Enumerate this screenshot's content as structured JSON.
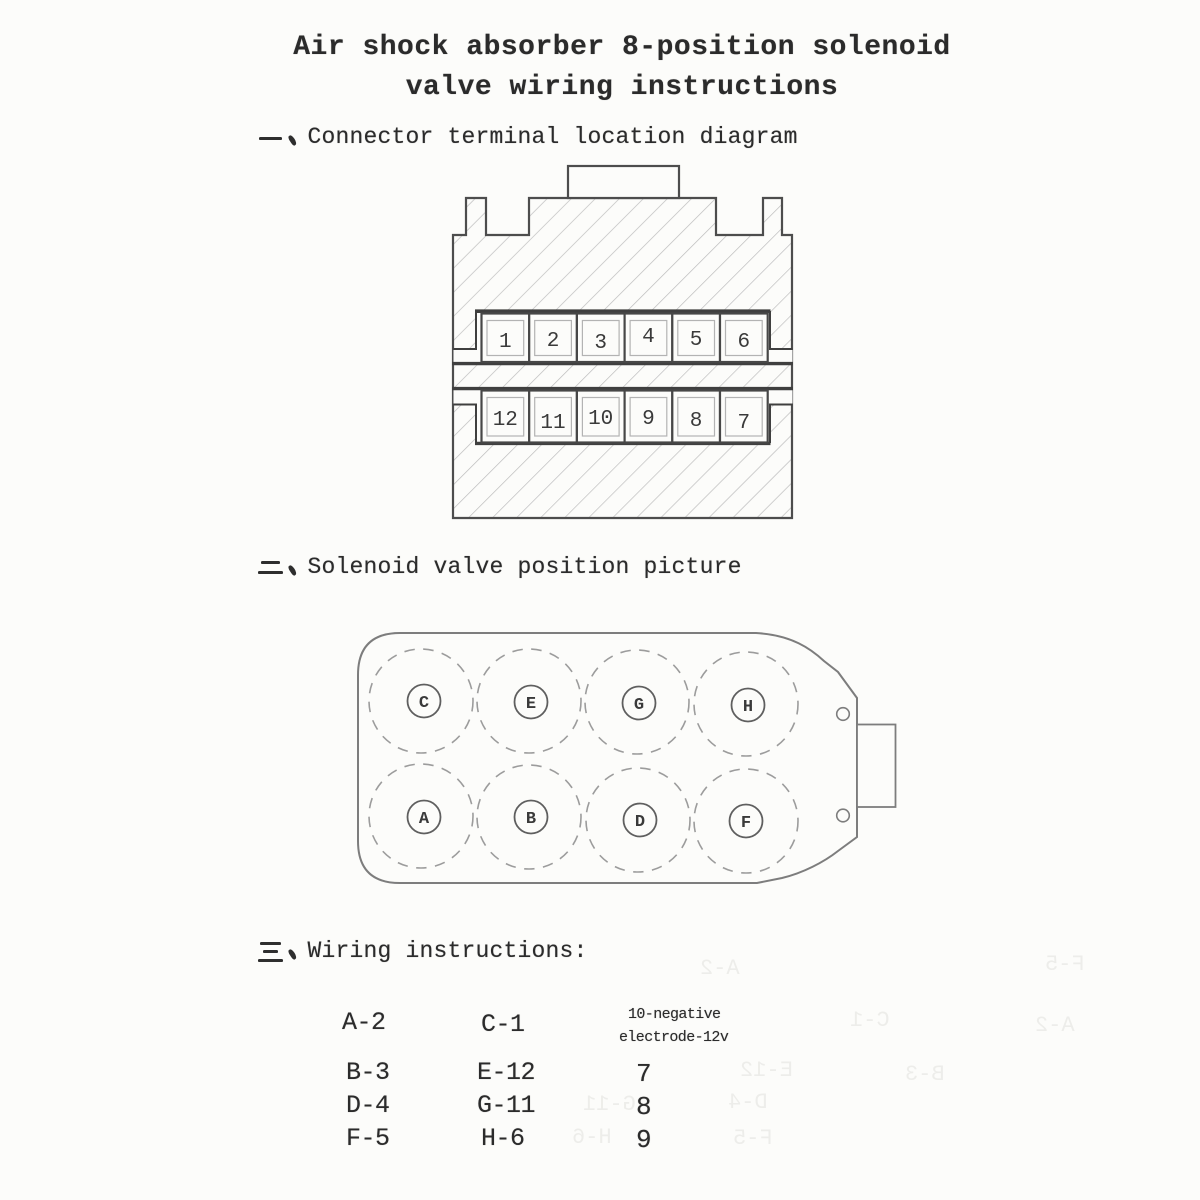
{
  "title": {
    "line1": "Air shock absorber 8-position solenoid",
    "line2": "valve wiring instructions"
  },
  "sections": {
    "s1": {
      "marker": "一、",
      "heading": "Connector terminal location diagram"
    },
    "s2": {
      "marker": "二、",
      "heading": "Solenoid valve position picture"
    },
    "s3": {
      "marker": "三、",
      "heading": "Wiring instructions:"
    }
  },
  "connector": {
    "top_row": [
      "1",
      "2",
      "3",
      "4",
      "5",
      "6"
    ],
    "bottom_row": [
      "12",
      "11",
      "10",
      "9",
      "8",
      "7"
    ]
  },
  "valve": {
    "top_row": [
      "C",
      "E",
      "G",
      "H"
    ],
    "bottom_row": [
      "A",
      "B",
      "D",
      "F"
    ]
  },
  "wiring": {
    "col1": [
      "A-2",
      "B-3",
      "D-4",
      "F-5"
    ],
    "col2": [
      "C-1",
      "E-12",
      "G-11",
      "H-6"
    ],
    "negative_note": [
      "10-negative",
      "electrode-12v"
    ],
    "col3": [
      "7",
      "8",
      "9"
    ]
  },
  "bleed_through": [
    "C-1",
    "A-2",
    "E-12",
    "B-3",
    "G-11",
    "D-4",
    "H-6",
    "F-5"
  ],
  "colors": {
    "ink": "#2b2b2b",
    "diagram_line": "#4d4d4d",
    "hatch": "#bdbdbd",
    "valve_line": "#7d7d7d",
    "dashed_circle": "#9c9c9c",
    "paper": "#fcfcfa"
  }
}
